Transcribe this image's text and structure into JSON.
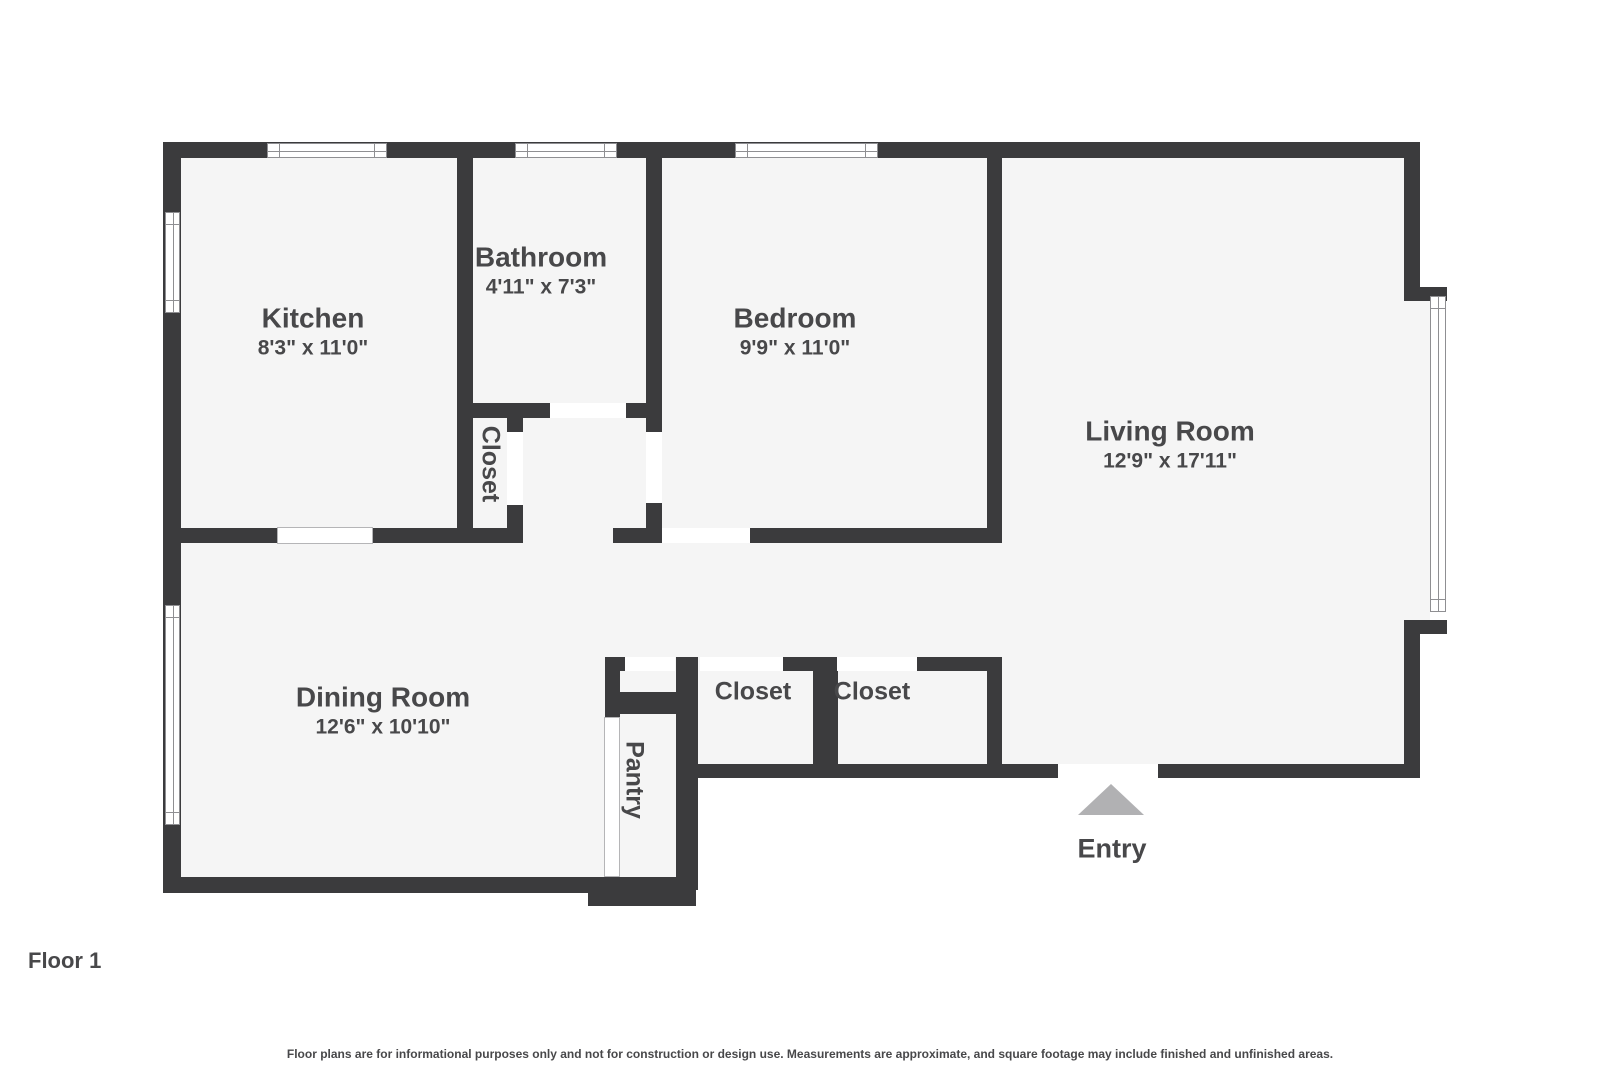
{
  "floorplan": {
    "floor_label": "Floor 1",
    "entry_label": "Entry",
    "disclaimer": "Floor plans are for informational purposes only and not for construction or design use. Measurements are approximate, and square footage may include finished and unfinished areas.",
    "rooms": [
      {
        "name": "Kitchen",
        "dimensions": "8'3\" x 11'0\""
      },
      {
        "name": "Bathroom",
        "dimensions": "4'11\" x 7'3\""
      },
      {
        "name": "Bedroom",
        "dimensions": "9'9\" x 11'0\""
      },
      {
        "name": "Living Room",
        "dimensions": "12'9\" x 17'11\""
      },
      {
        "name": "Dining Room",
        "dimensions": "12'6\" x 10'10\""
      },
      {
        "name": "Closet"
      },
      {
        "name": "Closet"
      },
      {
        "name": "Closet"
      },
      {
        "name": "Pantry"
      }
    ],
    "colors": {
      "wall": "#3b3b3d",
      "floor": "#f5f5f5",
      "label": "#48484a",
      "entry_arrow": "#b1b1b3",
      "window_line": "#8f8f92"
    }
  }
}
